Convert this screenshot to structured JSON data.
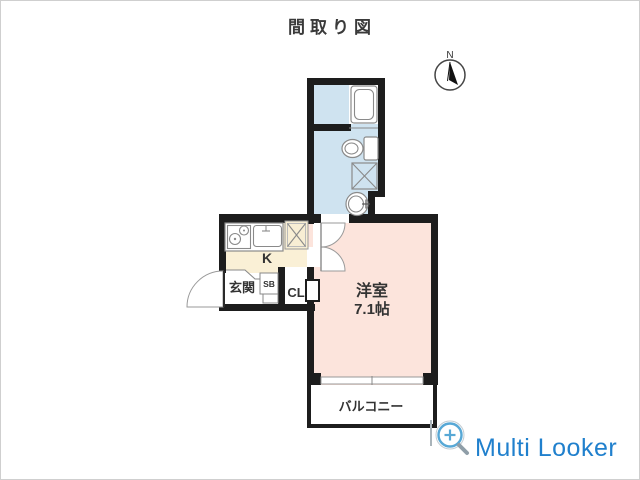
{
  "title": "間取り図",
  "compass": {
    "label": "N"
  },
  "rooms": {
    "washroom": {
      "note": "bath / toilet / laundry unit"
    },
    "kitchen": {
      "label": "K"
    },
    "entrance": {
      "label": "玄関"
    },
    "shoebox": {
      "label": "SB"
    },
    "closet": {
      "label": "CL"
    },
    "main": {
      "label": "洋室",
      "size": "7.1帖"
    },
    "balcony": {
      "label": "バルコニー"
    }
  },
  "watermark": {
    "label": "Multi Looker"
  },
  "colors": {
    "washroom": "#cfe3f0",
    "kitchen": "#faf0d6",
    "main_room": "#fce4dc",
    "wall": "#1d1d1d",
    "fixture_line": "#8a8a8a",
    "watermark_blue": "#2080cd",
    "text": "#3a3a3a"
  }
}
